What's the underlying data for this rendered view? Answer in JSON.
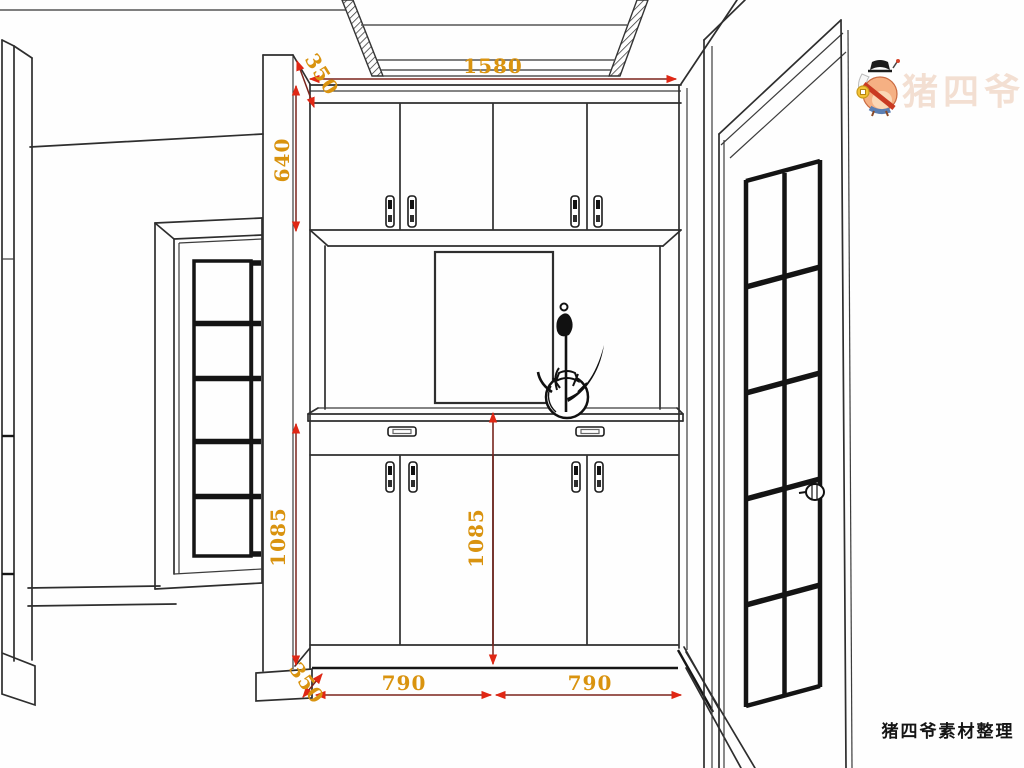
{
  "drawing": {
    "title": "entryway-cabinet-elevation",
    "dimensions": {
      "top_width": {
        "value": "1580"
      },
      "top_depth": {
        "value": "350"
      },
      "upper_cabinet_height": {
        "value": "640"
      },
      "left_lower_height": {
        "value": "1085"
      },
      "center_lower_height": {
        "value": "1085"
      },
      "bottom_left_width": {
        "value": "790"
      },
      "bottom_right_width": {
        "value": "790"
      },
      "bottom_depth": {
        "value": "350"
      }
    },
    "style": {
      "dimension_line_color": "#7b241c",
      "arrow_color": "#e02714",
      "dimension_text_color": "#d9930f",
      "line_color": "#2e2e2e",
      "background": "#fefefe"
    }
  },
  "watermark": {
    "mascot": "pig-mascot-icon",
    "faint_text": "猪四爷",
    "credit": "猪四爷素材整理"
  }
}
